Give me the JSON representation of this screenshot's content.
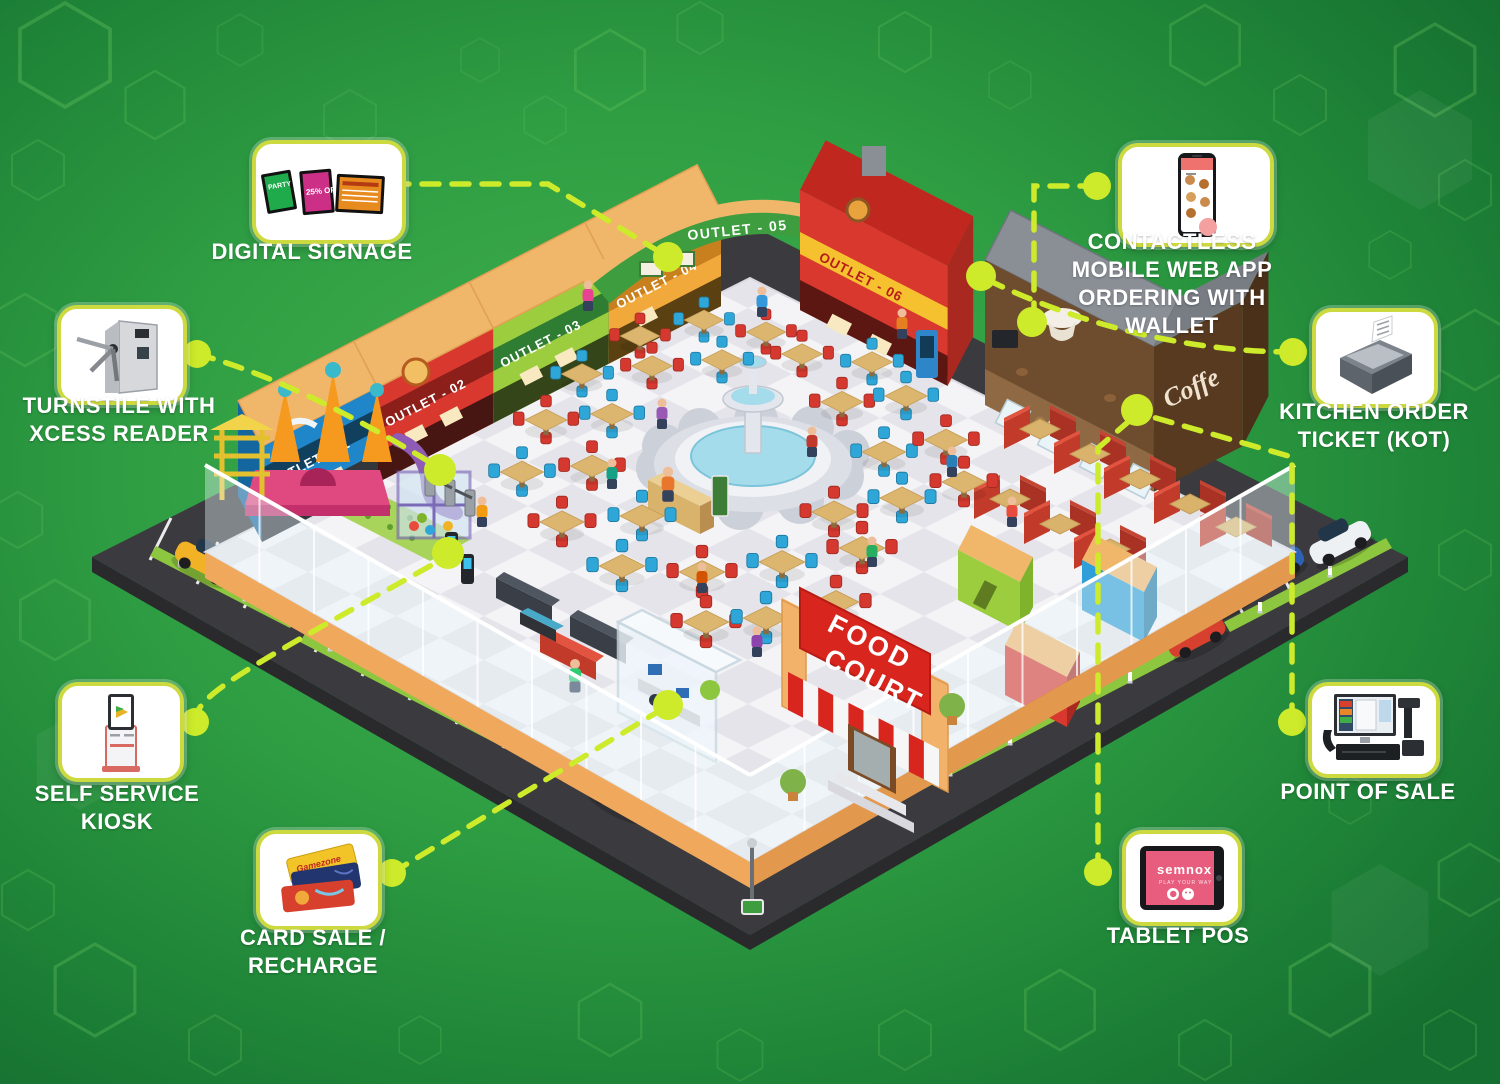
{
  "background": {
    "base": "#2f9e43",
    "light": "#44b24e",
    "dark": "#156f30",
    "hex_line": "#7fd96b"
  },
  "accent": {
    "connector": "#cdeb2a",
    "card_border": "#ccd93f",
    "label_color": "#ffffff"
  },
  "callouts": {
    "digital_signage": {
      "label": "DIGITAL SIGNAGE"
    },
    "contactless": {
      "label": "CONTACTLESS MOBILE WEB APP ORDERING WITH WALLET"
    },
    "turnstile": {
      "label": "TURNSTILE WITH XCESS READER"
    },
    "kot": {
      "label": "KITCHEN ORDER TICKET (KOT)"
    },
    "kiosk": {
      "label": "SELF SERVICE KIOSK"
    },
    "card_sale": {
      "label": "CARD SALE / RECHARGE"
    },
    "pos": {
      "label": "POINT OF SALE"
    },
    "tablet_pos": {
      "label": "TABLET POS"
    }
  },
  "icon_texts": {
    "signage_screen1": "PARTY DEALS",
    "signage_screen2": "25% OFF",
    "card_brand": "Gamezone",
    "tablet_brand": "semnox",
    "tablet_tagline": "PLAY YOUR WAY"
  },
  "foodcourt": {
    "outlet1": "OUTLET - 01",
    "outlet2": "OUTLET - 02",
    "outlet3": "OUTLET - 03",
    "outlet4": "OUTLET - 04",
    "outlet5": "OUTLET - 05",
    "outlet6": "OUTLET - 06",
    "coffee": "Coffe",
    "entrance_line1": "FOOD",
    "entrance_line2": "COURT"
  }
}
